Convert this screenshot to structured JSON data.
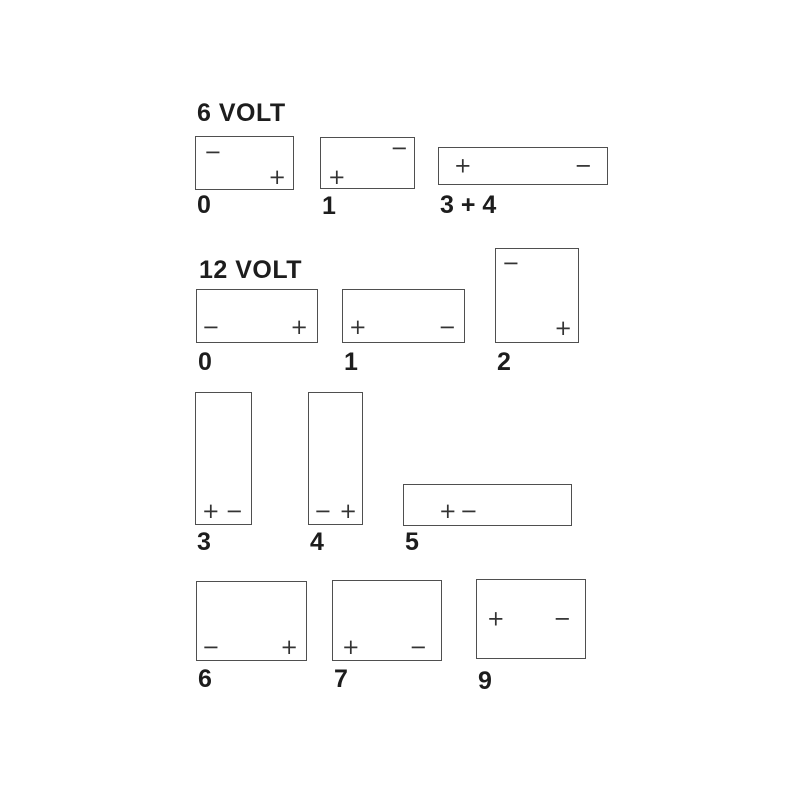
{
  "page": {
    "background": "#ffffff",
    "line_color": "#4f4f4f",
    "text_color": "#1d1d1d"
  },
  "sections": [
    {
      "id": "6-volt",
      "title": "6 VOLT"
    },
    {
      "id": "12-volt",
      "title": "12 VOLT"
    }
  ],
  "batteries": [
    {
      "section": "6 VOLT",
      "label": "0",
      "terminals": [
        {
          "sign": "−",
          "position": "top-left"
        },
        {
          "sign": "+",
          "position": "bottom-right"
        }
      ]
    },
    {
      "section": "6 VOLT",
      "label": "1",
      "terminals": [
        {
          "sign": "−",
          "position": "top-right"
        },
        {
          "sign": "+",
          "position": "bottom-left"
        }
      ]
    },
    {
      "section": "6 VOLT",
      "label": "3 + 4",
      "terminals": [
        {
          "sign": "+",
          "position": "middle-left"
        },
        {
          "sign": "−",
          "position": "middle-right"
        }
      ]
    },
    {
      "section": "12 VOLT",
      "label": "0",
      "terminals": [
        {
          "sign": "−",
          "position": "bottom-left"
        },
        {
          "sign": "+",
          "position": "bottom-right"
        }
      ]
    },
    {
      "section": "12 VOLT",
      "label": "1",
      "terminals": [
        {
          "sign": "+",
          "position": "bottom-left"
        },
        {
          "sign": "−",
          "position": "bottom-right"
        }
      ]
    },
    {
      "section": "12 VOLT",
      "label": "2",
      "terminals": [
        {
          "sign": "−",
          "position": "top-left"
        },
        {
          "sign": "+",
          "position": "bottom-right"
        }
      ]
    },
    {
      "section": "12 VOLT",
      "label": "3",
      "terminals": [
        {
          "sign": "+",
          "position": "bottom-left"
        },
        {
          "sign": "−",
          "position": "bottom-right"
        }
      ]
    },
    {
      "section": "12 VOLT",
      "label": "4",
      "terminals": [
        {
          "sign": "−",
          "position": "bottom-left"
        },
        {
          "sign": "+",
          "position": "bottom-right"
        }
      ]
    },
    {
      "section": "12 VOLT",
      "label": "5",
      "terminals": [
        {
          "sign": "+",
          "position": "bottom-left-of-center"
        },
        {
          "sign": "−",
          "position": "bottom-left-of-center"
        }
      ]
    },
    {
      "section": "12 VOLT",
      "label": "6",
      "terminals": [
        {
          "sign": "−",
          "position": "bottom-left"
        },
        {
          "sign": "+",
          "position": "bottom-right"
        }
      ]
    },
    {
      "section": "12 VOLT",
      "label": "7",
      "terminals": [
        {
          "sign": "+",
          "position": "bottom-left"
        },
        {
          "sign": "−",
          "position": "bottom-right"
        }
      ]
    },
    {
      "section": "12 VOLT",
      "label": "9",
      "terminals": [
        {
          "sign": "+",
          "position": "middle-left"
        },
        {
          "sign": "−",
          "position": "middle-right"
        }
      ]
    }
  ]
}
